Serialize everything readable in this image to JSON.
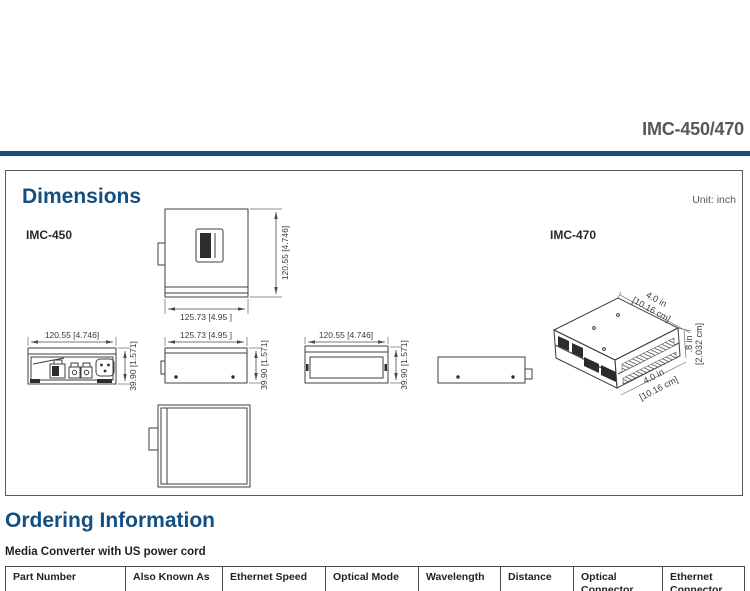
{
  "header": {
    "product_title": "IMC-450/470"
  },
  "dimensions": {
    "heading": "Dimensions",
    "unit_label": "Unit: inch",
    "model_450": "IMC-450",
    "model_470": "IMC-470",
    "labels": {
      "width": "120.55 [4.746]",
      "length": "125.73 [4.95 ]",
      "height": "39.90 [1.571]",
      "iso_top_in": "4.0 in",
      "iso_top_cm": "[10.16 cm]",
      "iso_depth_in": ".8 in",
      "iso_depth_cm": "[2.032 cm]",
      "iso_bottom_in": "4.0 in",
      "iso_bottom_cm": "[10.16 cm]"
    }
  },
  "ordering": {
    "heading": "Ordering Information",
    "subheading": "Media Converter with US power cord",
    "columns": [
      "Part Number",
      "Also Known As",
      "Ethernet Speed",
      "Optical Mode",
      "Wavelength",
      "Distance",
      "Optical Connector",
      "Ethernet Connector"
    ]
  },
  "colors": {
    "accent_blue": "#144f82",
    "title_gray": "#55575a",
    "drawing_line": "#3f3f41"
  }
}
